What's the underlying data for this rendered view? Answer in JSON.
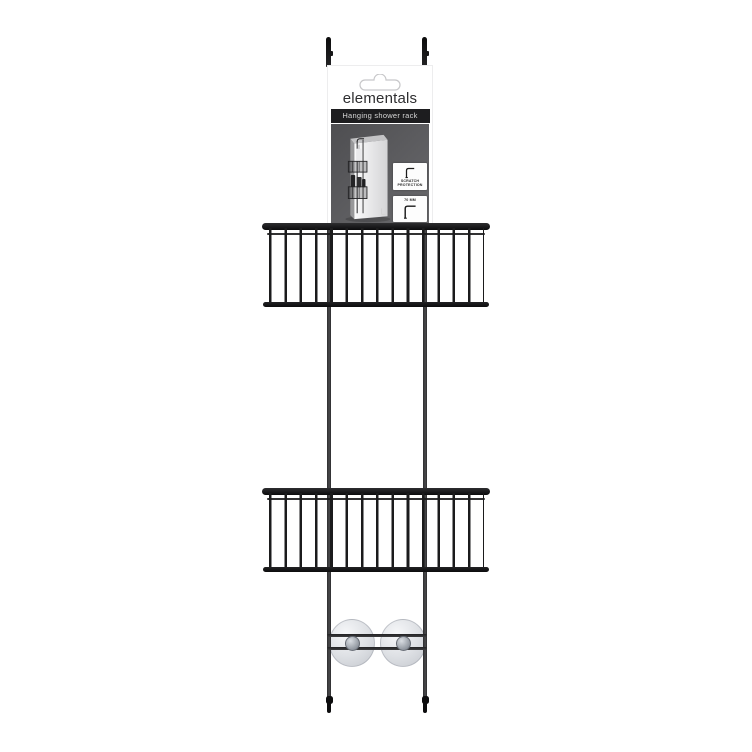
{
  "product": {
    "brand": "elementals",
    "label": "Hanging shower rack",
    "badges": [
      {
        "label": "SCRATCH PROTECTION"
      },
      {
        "label": "70 MM"
      }
    ]
  },
  "colors": {
    "rack_black": "#161617",
    "rail_gray": "#3a3a3c",
    "titlebar_bg": "#1d1d1f",
    "photo_bg_dark": "#4e4e51",
    "photo_bg_light": "#6a6a6d",
    "suction_cup": "#d2d5da",
    "background": "#ffffff"
  }
}
